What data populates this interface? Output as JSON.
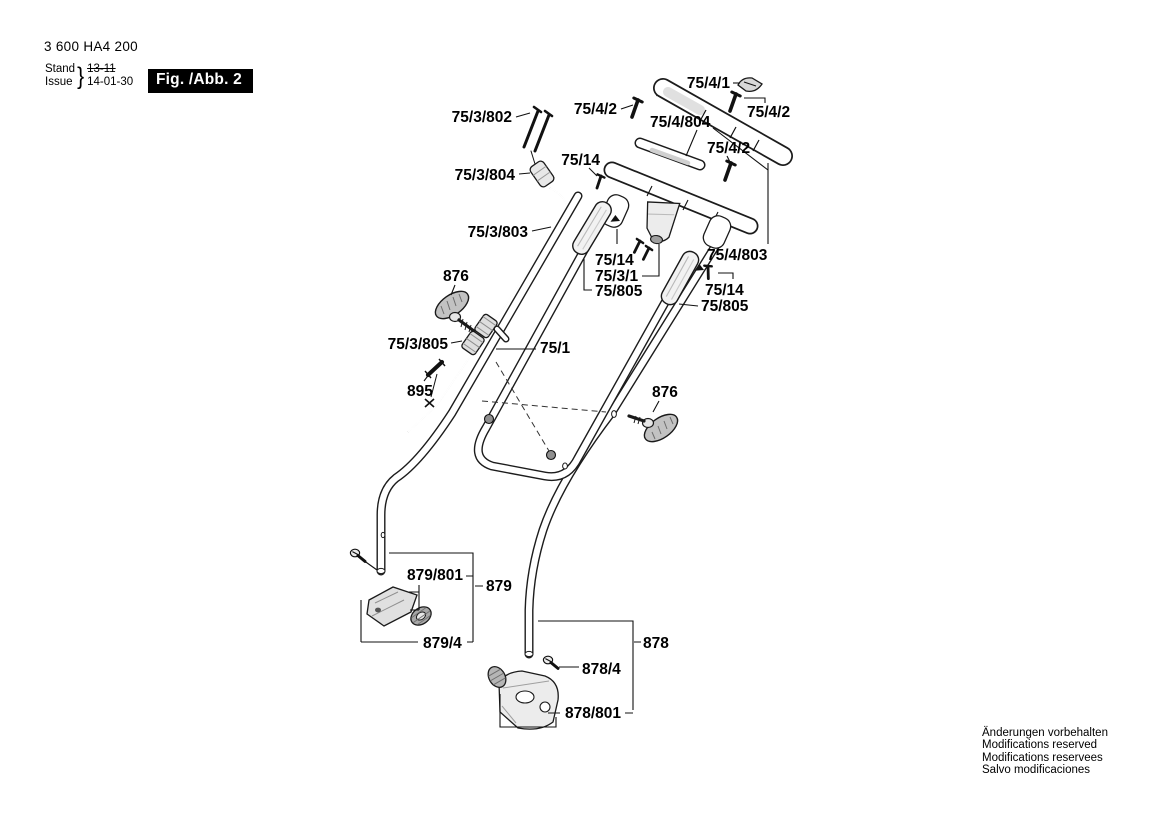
{
  "header": {
    "type_number": "3 600 HA4 200",
    "stand_label": "Stand",
    "issue_label": "Issue",
    "brace": "}",
    "stand_value": "13-11",
    "issue_value": "14-01-30",
    "figure_label": "Fig. /Abb. 2"
  },
  "diagram": {
    "description": "Exploded-view spare parts drawing of a lawnmower handle assembly",
    "labels": [
      {
        "id": "75-3-802",
        "text": "75/3/802"
      },
      {
        "id": "75-4-2-a",
        "text": "75/4/2"
      },
      {
        "id": "75-4-1",
        "text": "75/4/1"
      },
      {
        "id": "75-4-2-b",
        "text": "75/4/2"
      },
      {
        "id": "75-4-804",
        "text": "75/4/804"
      },
      {
        "id": "75-14-a",
        "text": "75/14"
      },
      {
        "id": "75-4-2-c",
        "text": "75/4/2"
      },
      {
        "id": "75-3-804",
        "text": "75/3/804"
      },
      {
        "id": "75-3-803",
        "text": "75/3/803"
      },
      {
        "id": "75-14-b",
        "text": "75/14"
      },
      {
        "id": "75-3-1",
        "text": "75/3/1"
      },
      {
        "id": "75-805-a",
        "text": "75/805"
      },
      {
        "id": "75-4-803",
        "text": "75/4/803"
      },
      {
        "id": "75-14-c",
        "text": "75/14"
      },
      {
        "id": "75-805-b",
        "text": "75/805"
      },
      {
        "id": "876-a",
        "text": "876"
      },
      {
        "id": "75-3-805",
        "text": "75/3/805"
      },
      {
        "id": "75-1",
        "text": "75/1"
      },
      {
        "id": "895",
        "text": "895"
      },
      {
        "id": "876-b",
        "text": "876"
      },
      {
        "id": "879-801",
        "text": "879/801"
      },
      {
        "id": "879",
        "text": "879"
      },
      {
        "id": "879-4",
        "text": "879/4"
      },
      {
        "id": "878",
        "text": "878"
      },
      {
        "id": "878-4",
        "text": "878/4"
      },
      {
        "id": "878-801",
        "text": "878/801"
      }
    ]
  },
  "footer": {
    "lines": [
      "Änderungen vorbehalten",
      "Modifications reserved",
      "Modifications reservees",
      "Salvo modificaciones"
    ]
  },
  "colors": {
    "ink": "#000000",
    "paper": "#ffffff",
    "badge_bg": "#000000",
    "badge_text": "#ffffff"
  }
}
